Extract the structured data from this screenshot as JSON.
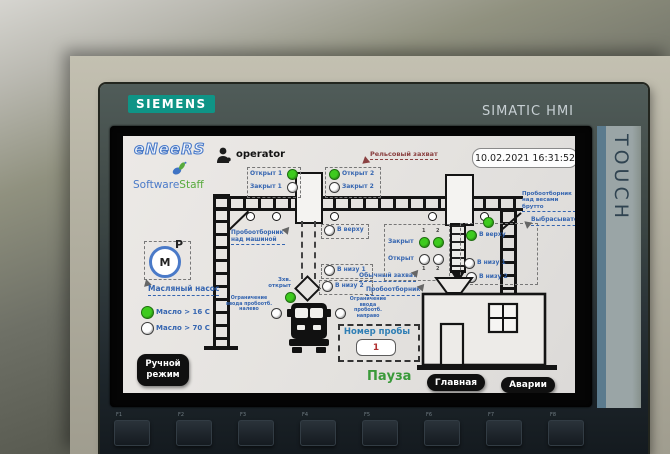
{
  "device": {
    "brand": "SIEMENS",
    "product": "SIMATIC HMI",
    "touch": "TOUCH",
    "function_keys": [
      "F1",
      "F2",
      "F3",
      "F4",
      "F5",
      "F6",
      "F7",
      "F8"
    ]
  },
  "colors": {
    "led_on": "#3ecb1e",
    "led_off": "#ffffff",
    "label_blue": "#3565b0",
    "label_maroon": "#8a4040",
    "pause_green": "#3a9a3a",
    "siemens_teal": "#0f9486"
  },
  "screen": {
    "logo_eneers": "eNeeRS",
    "logo_software": "Software",
    "logo_staff": "Staff",
    "user": "operator",
    "datetime": "10.02.2021 16:31:52",
    "rail_grip": "Рельсовый захват",
    "sampler_over_car": "Пробоотборник над машиной",
    "sampler_over_scales": "Пробоотборник над весами брутто",
    "ejector": "Выбрасыватель",
    "normal_grip": "Обычный захват",
    "sampler": "Пробоотборник",
    "motor_letter": "М",
    "motor_p": "P",
    "oil_pump": "Масляный насос",
    "indicators": {
      "open1": {
        "label": "Открыт 1",
        "state": "on"
      },
      "closed1": {
        "label": "Закрыт 1",
        "state": "off"
      },
      "open2": {
        "label": "Открыт 2",
        "state": "on"
      },
      "closed2": {
        "label": "Закрыт 2",
        "state": "off"
      },
      "top_left": {
        "label": "В верху",
        "state": "off"
      },
      "bottom1_left": {
        "label": "В низу 1",
        "state": "off"
      },
      "bottom2_left": {
        "label": "В низу 2",
        "state": "off"
      },
      "grip_open": {
        "label": "Зхв. открыт",
        "state": "on"
      },
      "limit_left": {
        "label": "Ограничение ввода пробоотб. налево",
        "state": "off"
      },
      "limit_right": {
        "label": "Ограничение ввода пробоотб. направо",
        "state": "off"
      },
      "right_closed": {
        "label": "Закрыт",
        "col1": "on",
        "col2": "on"
      },
      "right_open": {
        "label": "Открыт",
        "col1": "off",
        "col2": "off"
      },
      "col1": "1",
      "col2": "2",
      "top_right": {
        "label": "В верху",
        "state": "on"
      },
      "bottom1_right": {
        "label": "В низу 1",
        "state": "off"
      },
      "bottom2_right": {
        "label": "В низу 2",
        "state": "off"
      },
      "ejector_top": {
        "state": "on"
      },
      "oil16": {
        "label": "Масло > 16 С",
        "state": "on"
      },
      "oil70": {
        "label": "Масло > 70 С",
        "state": "off"
      }
    },
    "sample": {
      "label": "Номер пробы",
      "value": "1"
    },
    "buttons": {
      "manual": "Ручной режим",
      "pause": "Пауза",
      "main": "Главная",
      "alarms": "Аварии"
    }
  }
}
